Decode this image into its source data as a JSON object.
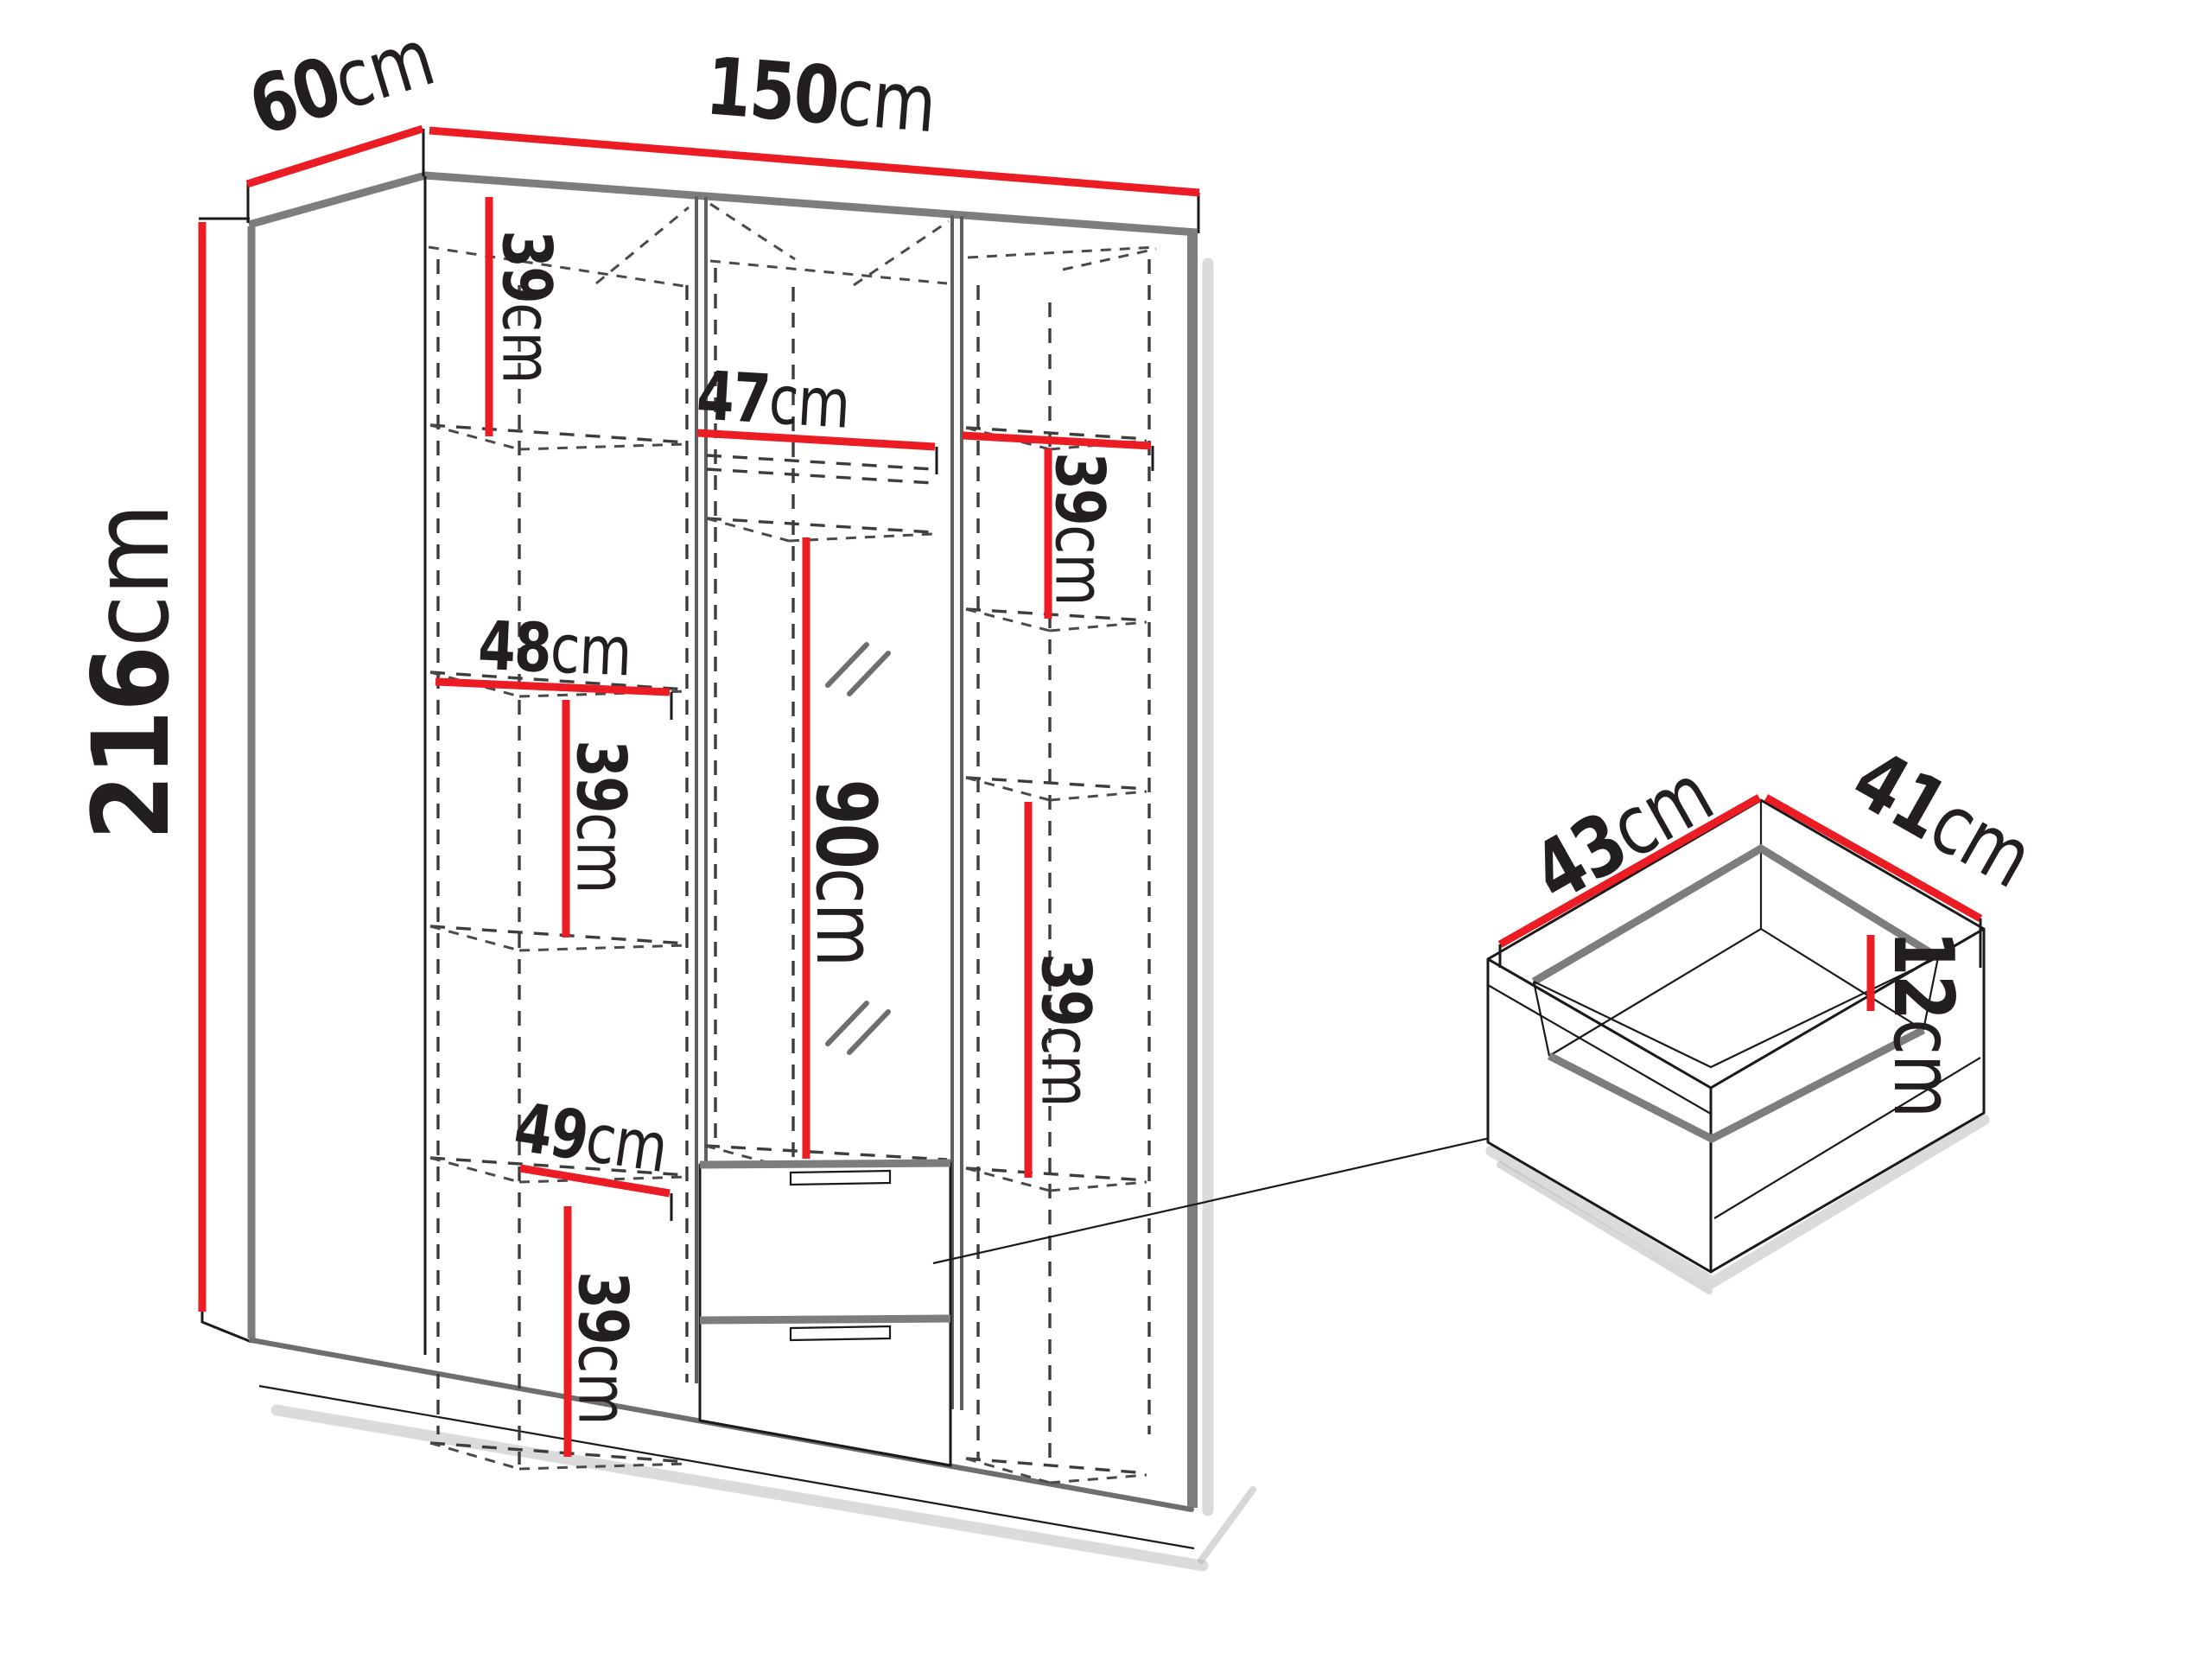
{
  "colors": {
    "dimension_accent": "#ec1c24",
    "outline": "#1a1a1a",
    "panel_gray": "#7d7d7d"
  },
  "wardrobe": {
    "width": {
      "value": "150",
      "unit": "cm"
    },
    "depth": {
      "value": "60",
      "unit": "cm"
    },
    "height": {
      "value": "216",
      "unit": "cm"
    },
    "left_column": {
      "top_section_height": {
        "value": "39",
        "unit": "cm"
      },
      "shelf_width": {
        "value": "48",
        "unit": "cm"
      },
      "middle_section_height": {
        "value": "39",
        "unit": "cm"
      },
      "lower_shelf_width": {
        "value": "49",
        "unit": "cm"
      },
      "bottom_section_height": {
        "value": "39",
        "unit": "cm"
      }
    },
    "middle_column": {
      "shelf_width": {
        "value": "47",
        "unit": "cm"
      },
      "hanging_space_height": {
        "value": "90",
        "unit": "cm"
      }
    },
    "right_column": {
      "top_section_height": {
        "value": "39",
        "unit": "cm"
      },
      "lower_section_height": {
        "value": "39",
        "unit": "cm"
      }
    }
  },
  "drawer_detail": {
    "inner_width": {
      "value": "43",
      "unit": "cm"
    },
    "inner_depth": {
      "value": "41",
      "unit": "cm"
    },
    "inner_height": {
      "value": "12",
      "unit": "cm"
    }
  }
}
